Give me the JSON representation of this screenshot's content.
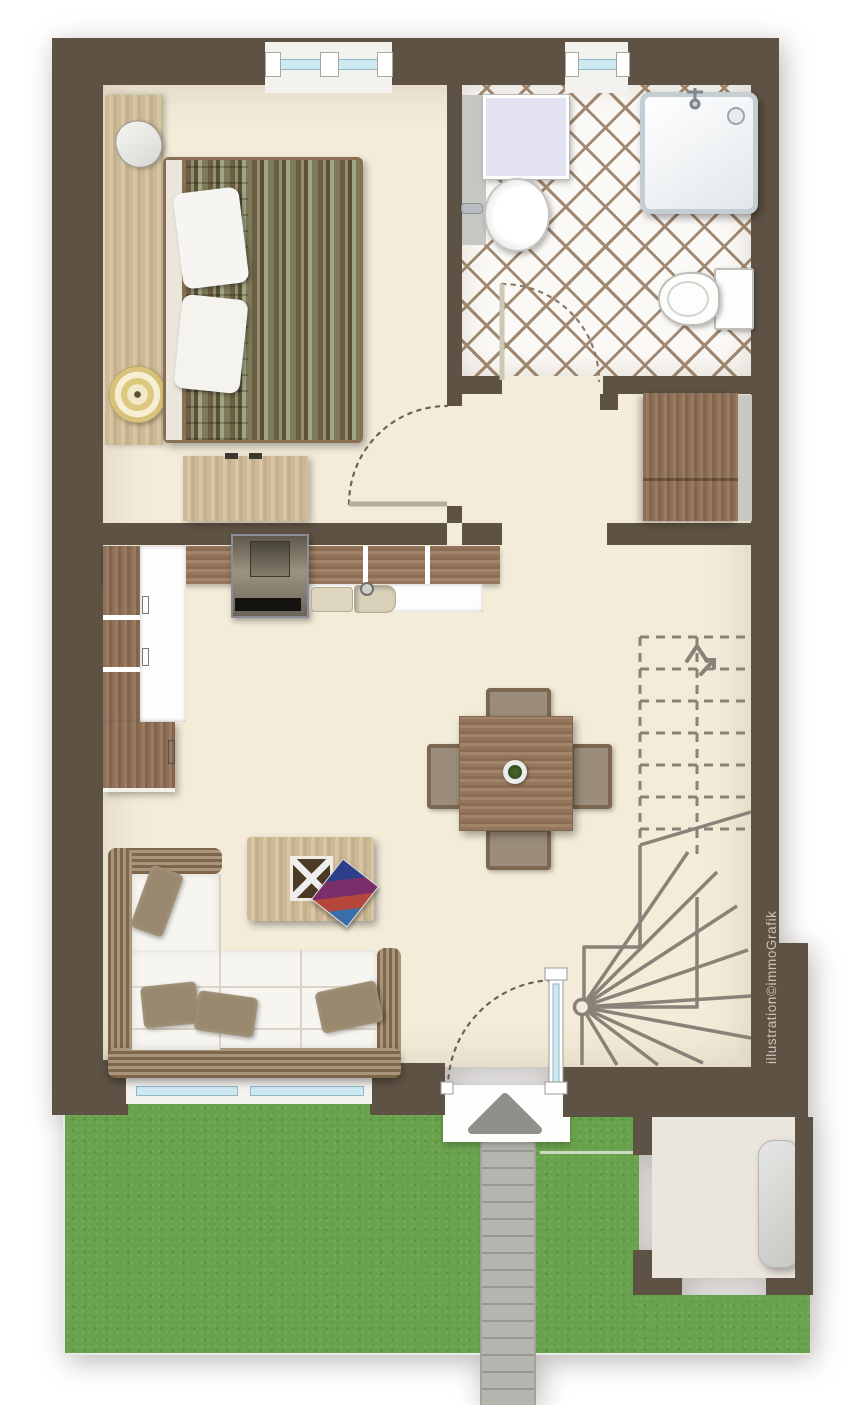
{
  "watermark": {
    "text": "illustration©immoGrafik"
  },
  "palette": {
    "wall": "#5e5244",
    "floor": "#f3ecd9",
    "tile_bg": "#fbf9f6",
    "tile_grout": "#a08871",
    "wood": "#9c7c60",
    "wood_light": "#d8c5a4",
    "console_wood": "#c9b695",
    "grass": "#69a24c",
    "glass": "#cfe9f2",
    "glass_frame": "#8fb9c6",
    "path_gray": "#b4b4af",
    "stair_line": "#8a8178",
    "shed_floor": "#ebe6dd",
    "wicker": "#9a8164",
    "cushion_white": "#f7f5f0",
    "pillow": "#99886e",
    "arc_color": "#6e6352",
    "watermark_color": "#cbc5b8"
  },
  "elements": [
    "bedroom",
    "bathroom",
    "hallway",
    "kitchen",
    "living-dining-room",
    "staircase",
    "entrance",
    "garden",
    "paved-path",
    "storage-shed"
  ]
}
